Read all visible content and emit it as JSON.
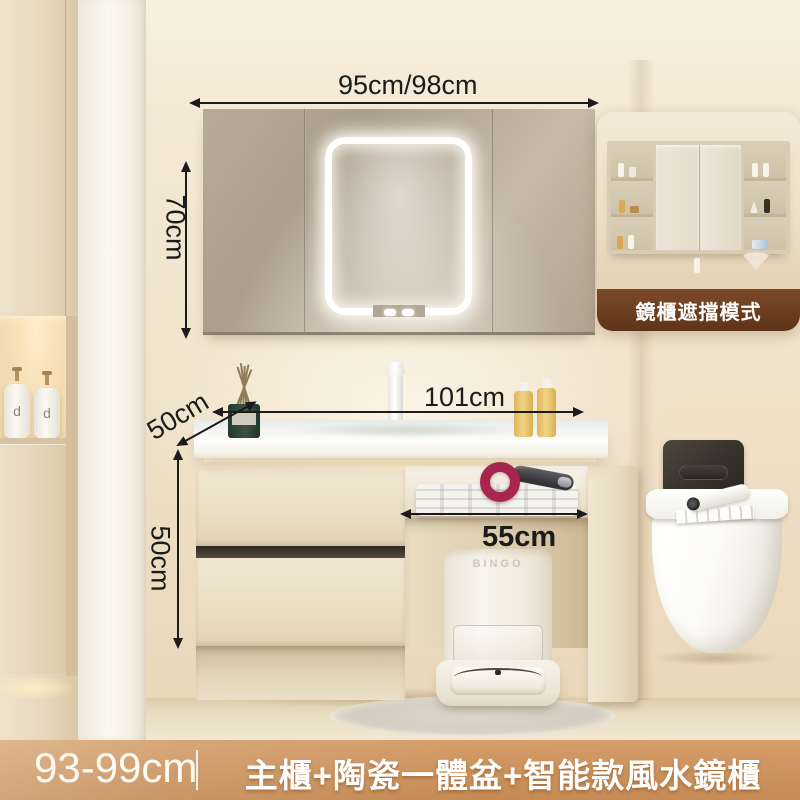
{
  "dimensions": {
    "top_width": "95cm/98cm",
    "mirror_height": "70cm",
    "basin_width": "101cm",
    "counter_depth": "50cm",
    "cabinet_height": "50cm",
    "open_shelf_width": "55cm"
  },
  "mirror_inset": {
    "caption": "鏡櫃遮擋模式"
  },
  "vacuum_dock": {
    "brand": "BINGO"
  },
  "left_cabinet": {
    "bottle_letter": "d"
  },
  "footer": {
    "height_range": "93-99cm",
    "product_title": "主櫃+陶瓷一體盆+智能款風水鏡櫃"
  },
  "colors": {
    "wall_beige": "#f2e5cf",
    "cabinet_cream": "#eaddc2",
    "mirror_taupe": "#b2a492",
    "led_glow": "#ffffff",
    "under_counter_light": "#ffedbd",
    "dryer_magenta": "#a82550",
    "flush_plate_dark": "#38322c",
    "inset_banner_brown": "#6f3d1f",
    "footer_orange": "#cf9158",
    "dimension_ink": "#1b1b1b"
  }
}
